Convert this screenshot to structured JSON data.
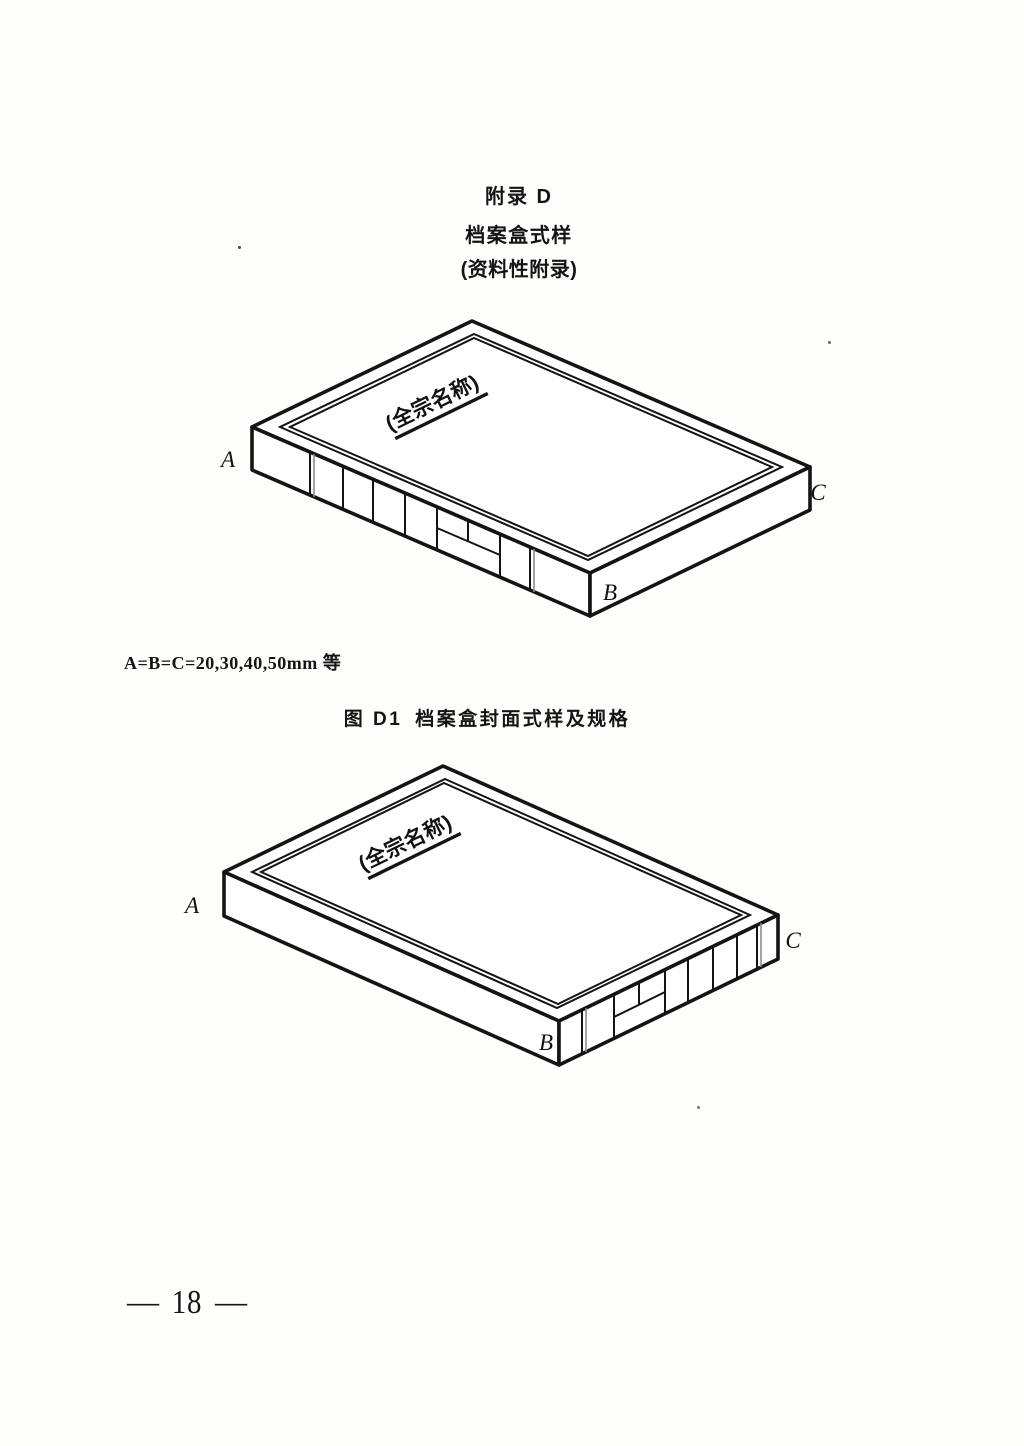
{
  "header": {
    "title": "附录 D",
    "subtitle": "档案盒式样",
    "note": "(资料性附录)"
  },
  "dimension_note": "A=B=C=20,30,40,50mm 等",
  "figure_caption": {
    "prefix": "图 D1",
    "text": "档案盒封面式样及规格"
  },
  "figure_top": {
    "cover_title": "(全宗名称)",
    "labels": {
      "a": "A",
      "b": "B",
      "c": "C"
    }
  },
  "figure_bottom": {
    "cover_title": "(全宗名称)",
    "labels": {
      "a": "A",
      "b": "B",
      "c": "C"
    }
  },
  "footer": {
    "dash": "—",
    "page_number": "18"
  },
  "colors": {
    "ink": "#141414",
    "paper": "#fefefd"
  }
}
